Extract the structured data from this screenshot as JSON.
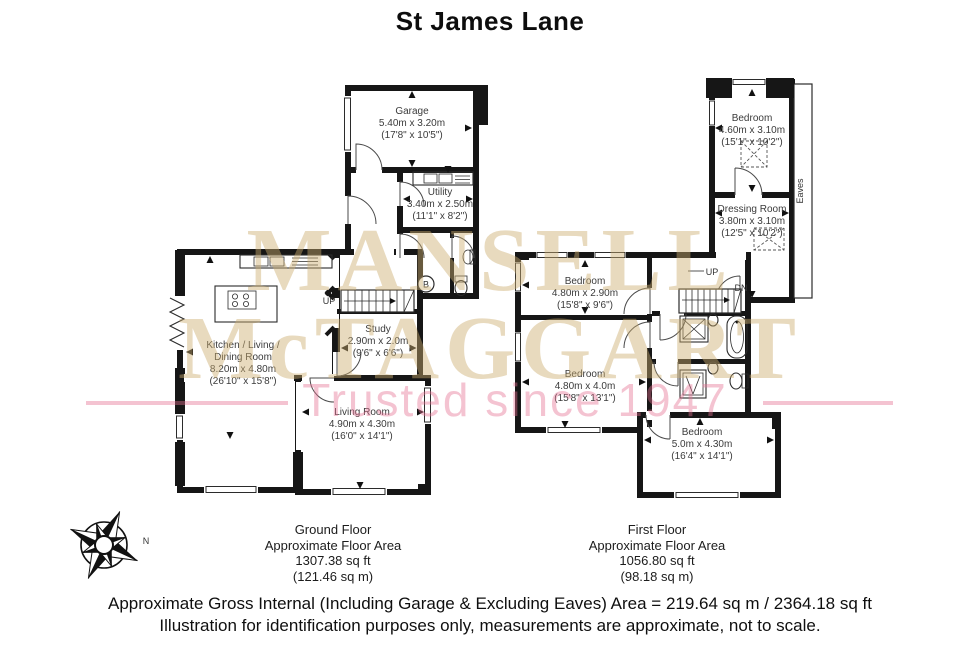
{
  "title": "St James Lane",
  "watermark": {
    "line1": "MANSELL",
    "line2": "McTAGGART",
    "tagline": "Trusted since 1947",
    "serif_color": "#cbac6e",
    "tagline_color": "#e57092"
  },
  "compass": {
    "north_label": "N"
  },
  "ground_floor": {
    "labels": {
      "up": "UP",
      "boiler": "B"
    },
    "rooms": {
      "garage": {
        "name": "Garage",
        "metric": "5.40m x 3.20m",
        "imperial": "(17'8\" x 10'5\")"
      },
      "utility": {
        "name": "Utility",
        "metric": "3.40m x 2.50m",
        "imperial": "(11'1\" x 8'2\")"
      },
      "study": {
        "name": "Study",
        "metric": "2.90m x 2.0m",
        "imperial": "(9'6\" x 6'6\")"
      },
      "kitchen": {
        "name_line1": "Kitchen / Living /",
        "name_line2": "Dining Room",
        "metric": "8.20m x 4.80m",
        "imperial": "(26'10\" x 15'8\")"
      },
      "living": {
        "name": "Living Room",
        "metric": "4.90m x 4.30m",
        "imperial": "(16'0\" x 14'1\")"
      }
    },
    "caption": {
      "floor": "Ground Floor",
      "area_label": "Approximate Floor Area",
      "area_sqft": "1307.38 sq ft",
      "area_sqm": "(121.46 sq m)"
    }
  },
  "first_floor": {
    "labels": {
      "up": "UP",
      "down": "DN",
      "eaves": "Eaves"
    },
    "rooms": {
      "bedroom_top": {
        "name": "Bedroom",
        "metric": "4.60m x 3.10m",
        "imperial": "(15'1\" x 10'2\")"
      },
      "dressing": {
        "name": "Dressing Room",
        "metric": "3.80m x 3.10m",
        "imperial": "(12'5\" x 10'2\")"
      },
      "bedroom_left": {
        "name": "Bedroom",
        "metric": "4.80m x 2.90m",
        "imperial": "(15'8\" x 9'6\")"
      },
      "bedroom_mid": {
        "name": "Bedroom",
        "metric": "4.80m x 4.0m",
        "imperial": "(15'8\" x 13'1\")"
      },
      "bedroom_bottom": {
        "name": "Bedroom",
        "metric": "5.0m x 4.30m",
        "imperial": "(16'4\" x 14'1\")"
      }
    },
    "caption": {
      "floor": "First Floor",
      "area_label": "Approximate Floor Area",
      "area_sqft": "1056.80 sq ft",
      "area_sqm": "(98.18 sq m)"
    }
  },
  "footer": {
    "line1": "Approximate Gross Internal (Including Garage & Excluding Eaves) Area = 219.64 sq m / 2364.18 sq ft",
    "line2": "Illustration for identification purposes only, measurements are approximate, not to scale."
  }
}
